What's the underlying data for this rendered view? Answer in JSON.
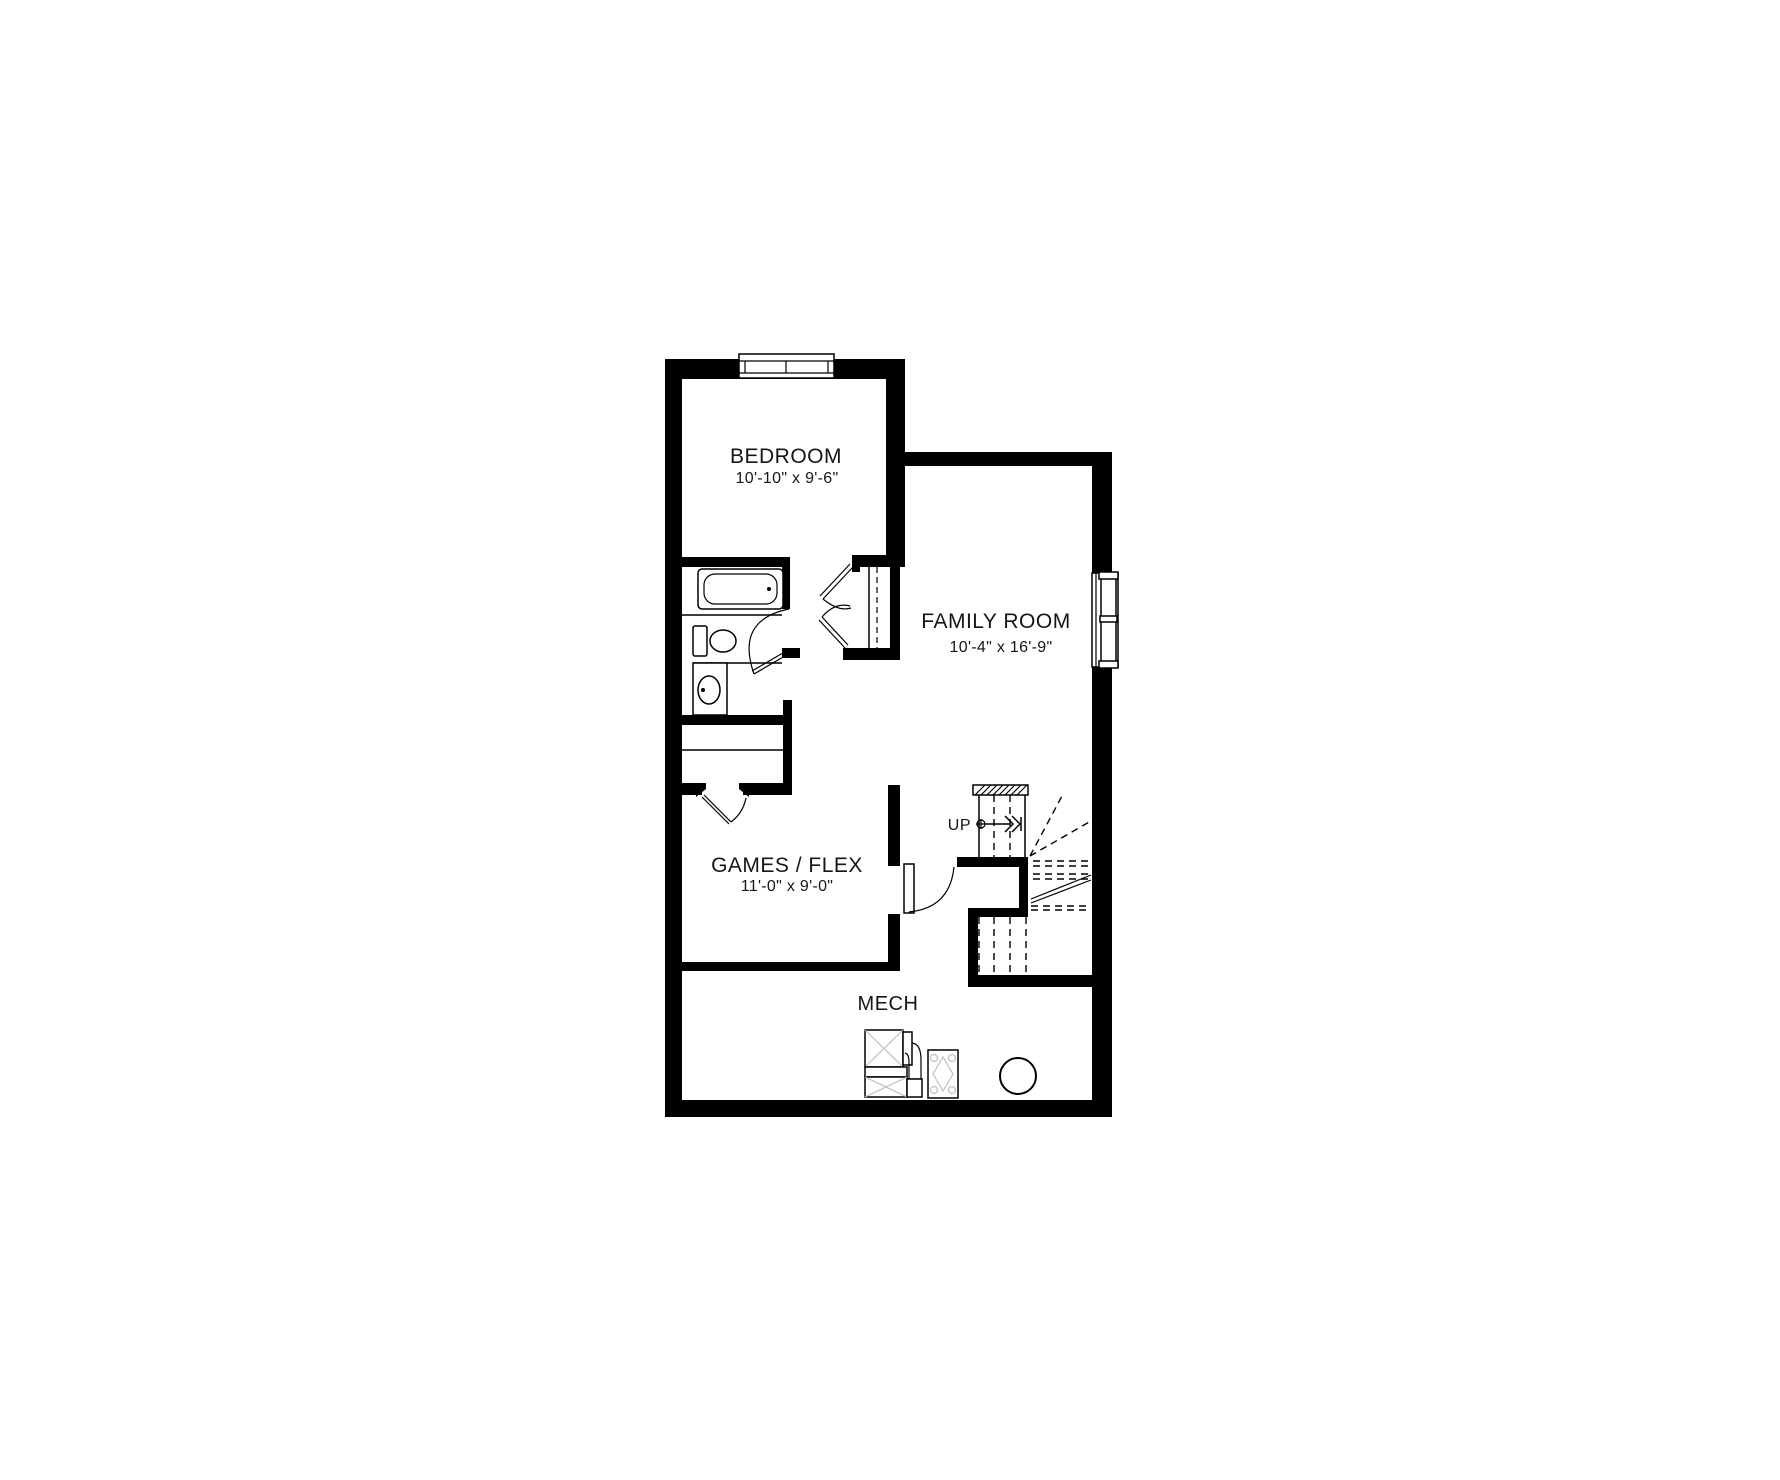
{
  "plan": {
    "rooms": {
      "bedroom": {
        "label": "BEDROOM",
        "dims": "10'-10\" x 9'-6\""
      },
      "family_room": {
        "label": "FAMILY ROOM",
        "dims": "10'-4\" x 16'-9\""
      },
      "games_flex": {
        "label": "GAMES / FLEX",
        "dims": "11'-0\" x 9'-0\""
      },
      "mech": {
        "label": "MECH"
      }
    },
    "stairs": {
      "direction_label": "UP"
    },
    "colors": {
      "wall": "#000000",
      "background": "#ffffff",
      "line": "#000000",
      "fixture_detail": "#bfbfbf",
      "text": "#161616"
    }
  }
}
